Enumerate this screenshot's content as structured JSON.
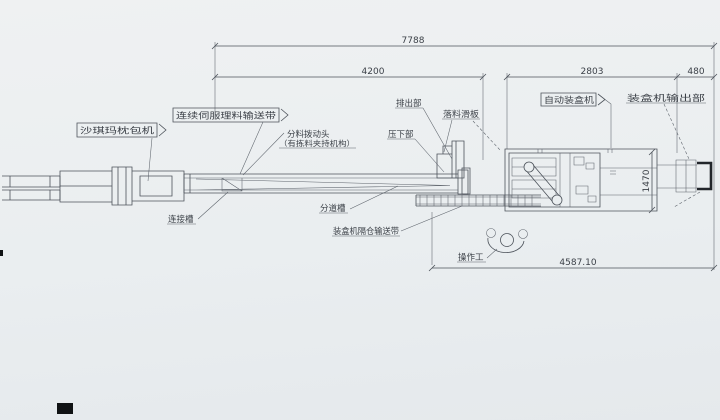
{
  "drawing": {
    "dims": {
      "total_length": "7788",
      "conveyor_length": "4200",
      "cartoner_length": "2803",
      "output_length": "480",
      "cartoner_width": "1470",
      "line_length": "4587.10"
    },
    "labels": {
      "pillow_packer": "沙琪玛枕包机",
      "servo_conveyor": "连续伺服理料输送带",
      "divider_head": "分料拨动头",
      "divider_head_note": "（有拣料夹持机构）",
      "discharge": "排出部",
      "drop_slide": "落料滑板",
      "press_down": "压下部",
      "auto_cartoner": "自动装盒机",
      "cartoner_output": "装盒机输出部",
      "connect_chute": "连接槽",
      "divide_chute": "分道槽",
      "compartment_conveyor": "装盒机隔仓输送带",
      "operator": "操作工"
    }
  }
}
